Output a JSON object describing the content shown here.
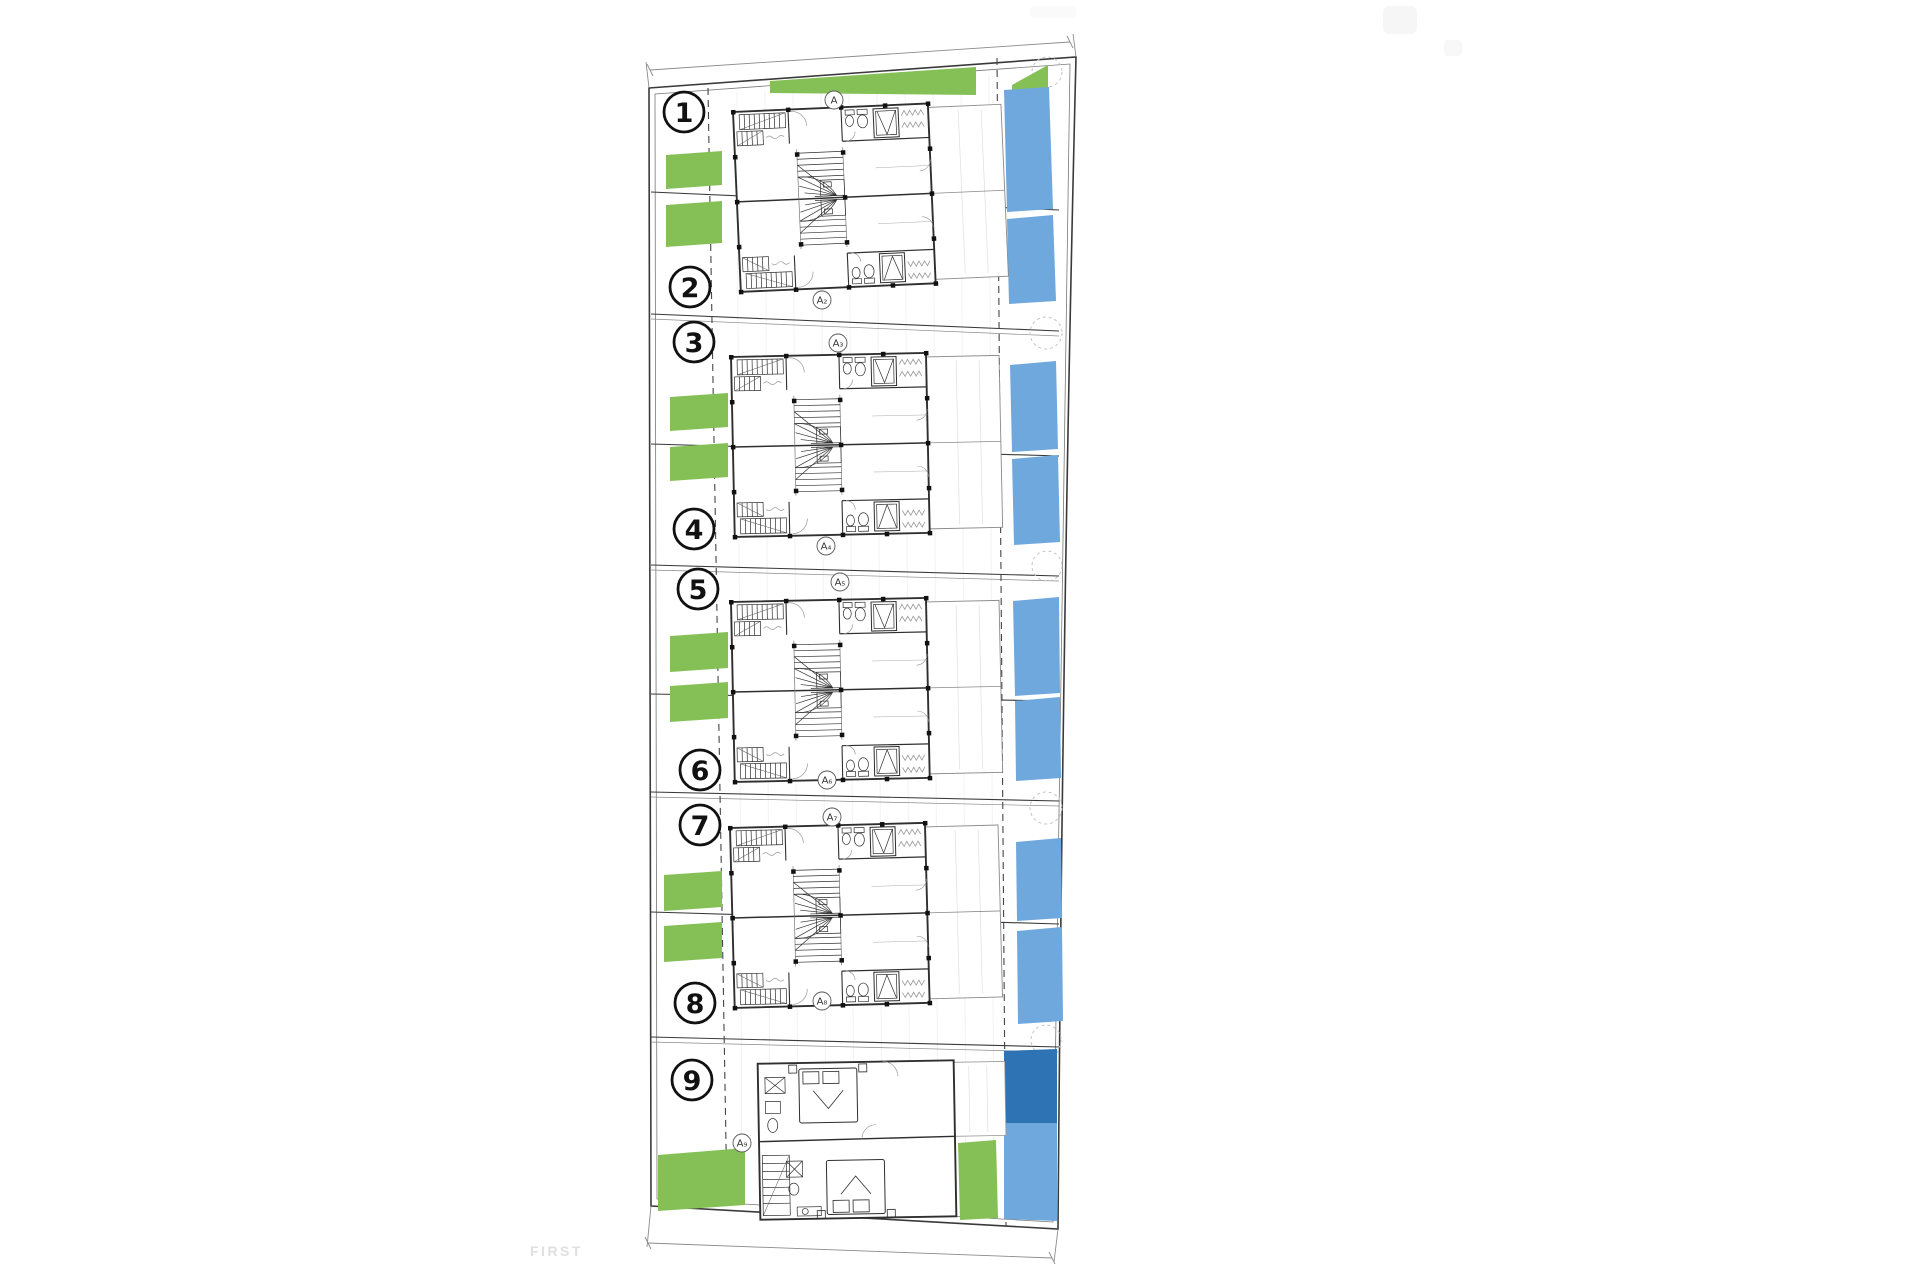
{
  "drawing": {
    "floor_label": "FIRST",
    "units": [
      {
        "number": "1"
      },
      {
        "number": "2"
      },
      {
        "number": "3"
      },
      {
        "number": "4"
      },
      {
        "number": "5"
      },
      {
        "number": "6"
      },
      {
        "number": "7"
      },
      {
        "number": "8"
      },
      {
        "number": "9"
      }
    ],
    "section_markers": [
      {
        "label": "A"
      },
      {
        "label": "A₂"
      },
      {
        "label": "A₃"
      },
      {
        "label": "A₄"
      },
      {
        "label": "A₅"
      },
      {
        "label": "A₆"
      },
      {
        "label": "A₇"
      },
      {
        "label": "A₈"
      },
      {
        "label": "A₉"
      }
    ],
    "colors": {
      "garden": "#85c057",
      "pool": "#6fa8dc",
      "pool_dark": "#2e74b5",
      "line": "#2f2f2f",
      "watermark": "#e0e0e0"
    }
  }
}
